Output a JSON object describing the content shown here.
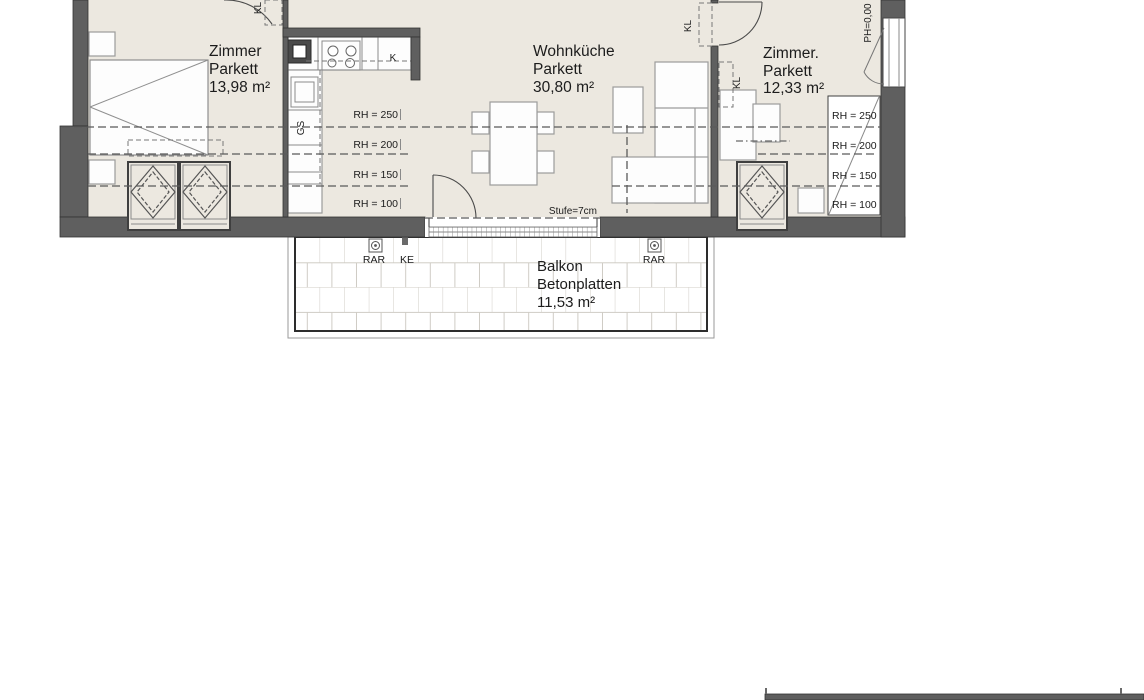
{
  "floorplan": {
    "rooms": [
      {
        "name": "Zimmer",
        "floor": "Parkett",
        "area": "13,98 m²"
      },
      {
        "name": "Wohnküche",
        "floor": "Parkett",
        "area": "30,80 m²"
      },
      {
        "name": "Zimmer.",
        "floor": "Parkett",
        "area": "12,33 m²"
      },
      {
        "name": "Balkon",
        "floor": "Betonplatten",
        "area": "11,53 m²"
      }
    ],
    "room_heights_left": [
      "RH = 250",
      "RH = 200",
      "RH = 150",
      "RH = 100"
    ],
    "room_heights_right": [
      "RH = 250",
      "RH = 200",
      "RH = 150",
      "RH = 100"
    ],
    "labels": {
      "step": "Stufe=7cm",
      "parapet": "PH=0,00",
      "fridge": "K",
      "dishwasher": "GS",
      "closet_top": "KL",
      "closet_door": "KL",
      "closet_room": "KL",
      "drain_left": "RAR",
      "drain_right": "RAR",
      "downpipe": "KE"
    },
    "colors": {
      "floor": "#ece8e0",
      "wall": "#5f5f5f",
      "line": "#555555"
    }
  }
}
